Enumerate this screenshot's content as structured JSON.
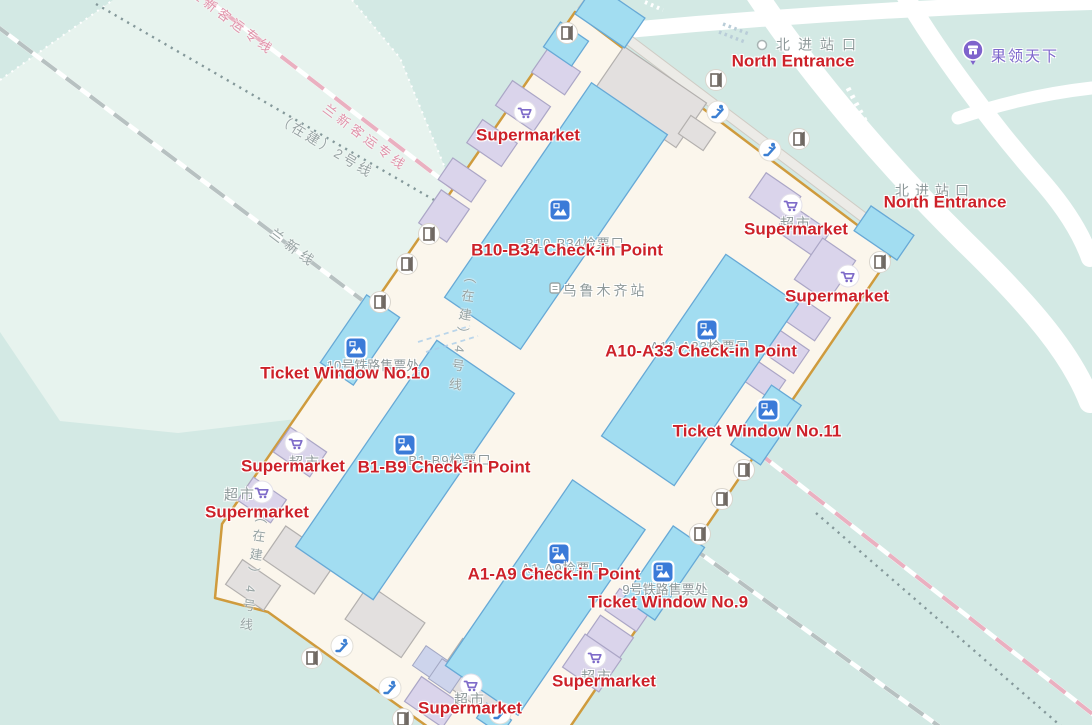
{
  "map": {
    "station": {
      "name_cn": "乌鲁木齐站"
    },
    "colors": {
      "background_teal": "#d3e9e4",
      "light_area": "#e7f3ee",
      "building_fill": "#fbf6ec",
      "building_border": "#cf9b3d",
      "checkin_fill": "#a2ddf1",
      "checkin_stroke": "#67a9d6",
      "shop_fill": "#dad4eb",
      "gray_building": "#e3e0df",
      "poi_red": "#cd2129",
      "map_gray_text": "#8e999a",
      "rail_pink": "#eab0c0",
      "purple_poi": "#7d66cc",
      "road_white": "#ffffff"
    },
    "rail_lines": [
      {
        "name": "兰新客运专线",
        "style": "pink-white-dashed"
      },
      {
        "name": "（在建）2号线",
        "style": "gray-dotted"
      },
      {
        "name": "兰新线",
        "style": "gray-white-dashed"
      },
      {
        "name": "（在建）4号线",
        "style": "under-construction-vertical-label"
      }
    ],
    "labels": [
      {
        "name": "rail-label",
        "kind": "pink",
        "text": "兰新客运专线",
        "x": 232,
        "y": 22,
        "rot": 37,
        "clickable": false
      },
      {
        "name": "rail-label",
        "kind": "pink",
        "text": "兰新客运专线",
        "x": 365,
        "y": 138,
        "rot": 37,
        "clickable": false
      },
      {
        "name": "rail-label",
        "kind": "rail",
        "text": "（在建）2号线",
        "x": 325,
        "y": 147,
        "rot": 31,
        "clickable": false
      },
      {
        "name": "rail-label",
        "kind": "rail",
        "text": "兰新线",
        "x": 293,
        "y": 249,
        "rot": 37,
        "ls": 5,
        "clickable": false
      },
      {
        "name": "rail-label-vertical",
        "kind": "railv",
        "text": "（在建）4号线",
        "x": 461,
        "y": 333,
        "rot": 8,
        "clickable": false
      },
      {
        "name": "rail-label-vertical",
        "kind": "railv",
        "text": "（在建）4号线",
        "x": 252,
        "y": 573,
        "rot": 8,
        "clickable": false
      },
      {
        "name": "north-entrance-cn-label",
        "kind": "cn",
        "text": "北进站口",
        "x": 820,
        "y": 45,
        "ls": 8,
        "clickable": true
      },
      {
        "name": "north-entrance-cn-label",
        "kind": "cn",
        "text": "北进站口",
        "x": 935,
        "y": 191,
        "ls": 6,
        "clickable": true
      },
      {
        "name": "station-name-label",
        "kind": "cn",
        "text": "乌鲁木齐站",
        "x": 605,
        "y": 291,
        "clickable": true
      },
      {
        "name": "checkin-cn-label",
        "kind": "cn",
        "text": "B10-B34检票口",
        "x": 575,
        "y": 244,
        "size": 13,
        "ls": 1,
        "clickable": true
      },
      {
        "name": "checkin-cn-label",
        "kind": "cn",
        "text": "A10-A33检票口",
        "x": 700,
        "y": 347,
        "size": 13,
        "ls": 1,
        "clickable": true
      },
      {
        "name": "checkin-cn-label",
        "kind": "cn",
        "text": "B1-B9检票口",
        "x": 450,
        "y": 461,
        "size": 13,
        "ls": 1,
        "clickable": true
      },
      {
        "name": "checkin-cn-label",
        "kind": "cn",
        "text": "A1-A9检票口",
        "x": 563,
        "y": 569,
        "size": 13,
        "ls": 1,
        "clickable": true
      },
      {
        "name": "ticket-window-cn-label",
        "kind": "cn",
        "text": "10号铁路售票处",
        "x": 373,
        "y": 366,
        "size": 13,
        "ls": 0,
        "clickable": true
      },
      {
        "name": "ticket-window-cn-label",
        "kind": "cn",
        "text": "9号铁路售票处",
        "x": 665,
        "y": 590,
        "size": 13,
        "ls": 0,
        "clickable": true
      },
      {
        "name": "supermarket-cn-label",
        "kind": "cn",
        "text": "超市",
        "x": 305,
        "y": 463,
        "ls": 2,
        "clickable": true
      },
      {
        "name": "supermarket-cn-label",
        "kind": "cn",
        "text": "超市",
        "x": 240,
        "y": 495,
        "ls": 2,
        "clickable": true
      },
      {
        "name": "supermarket-cn-label",
        "kind": "cn",
        "text": "超市",
        "x": 597,
        "y": 677,
        "ls": 2,
        "clickable": true
      },
      {
        "name": "supermarket-cn-label",
        "kind": "cn",
        "text": "超市",
        "x": 470,
        "y": 700,
        "ls": 2,
        "clickable": true
      },
      {
        "name": "supermarket-cn-label",
        "kind": "cn",
        "text": "超市",
        "x": 796,
        "y": 224,
        "ls": 2,
        "clickable": true
      },
      {
        "name": "supermarket-label",
        "kind": "poi",
        "text": "Supermarket",
        "x": 528,
        "y": 136,
        "clickable": true
      },
      {
        "name": "north-entrance-label",
        "kind": "poi",
        "text": "North Entrance",
        "x": 793,
        "y": 62,
        "clickable": true
      },
      {
        "name": "north-entrance-label",
        "kind": "poi",
        "text": "North Entrance",
        "x": 945,
        "y": 203,
        "clickable": true
      },
      {
        "name": "supermarket-label",
        "kind": "poi",
        "text": "Supermarket",
        "x": 796,
        "y": 230,
        "clickable": true
      },
      {
        "name": "supermarket-label",
        "kind": "poi",
        "text": "Supermarket",
        "x": 837,
        "y": 297,
        "clickable": true
      },
      {
        "name": "checkin-label",
        "kind": "poi",
        "text": "B10-B34 Check-in Point",
        "x": 567,
        "y": 251,
        "clickable": true
      },
      {
        "name": "checkin-label",
        "kind": "poi",
        "text": "A10-A33 Check-in Point",
        "x": 701,
        "y": 352,
        "clickable": true
      },
      {
        "name": "ticket-window-label",
        "kind": "poi",
        "text": "Ticket Window No.10",
        "x": 345,
        "y": 374,
        "clickable": true
      },
      {
        "name": "ticket-window-label",
        "kind": "poi",
        "text": "Ticket Window No.11",
        "x": 757,
        "y": 432,
        "clickable": true
      },
      {
        "name": "supermarket-label",
        "kind": "poi",
        "text": "Supermarket",
        "x": 293,
        "y": 467,
        "clickable": true
      },
      {
        "name": "checkin-label",
        "kind": "poi",
        "text": "B1-B9 Check-in Point",
        "x": 444,
        "y": 468,
        "clickable": true
      },
      {
        "name": "supermarket-label",
        "kind": "poi",
        "text": "Supermarket",
        "x": 257,
        "y": 513,
        "clickable": true
      },
      {
        "name": "checkin-label",
        "kind": "poi",
        "text": "A1-A9 Check-in Point",
        "x": 554,
        "y": 575,
        "clickable": true
      },
      {
        "name": "ticket-window-label",
        "kind": "poi",
        "text": "Ticket Window No.9",
        "x": 668,
        "y": 603,
        "clickable": true
      },
      {
        "name": "supermarket-label",
        "kind": "poi",
        "text": "Supermarket",
        "x": 604,
        "y": 682,
        "clickable": true
      },
      {
        "name": "supermarket-label",
        "kind": "poi",
        "text": "Supermarket",
        "x": 470,
        "y": 709,
        "clickable": true
      },
      {
        "name": "shop-poi-label",
        "kind": "shop",
        "text": "果领天下",
        "x": 1025,
        "y": 57,
        "clickable": true
      }
    ],
    "icons": [
      {
        "type": "checkin",
        "x": 560,
        "y": 210
      },
      {
        "type": "checkin",
        "x": 707,
        "y": 330
      },
      {
        "type": "checkin",
        "x": 405,
        "y": 445
      },
      {
        "type": "checkin",
        "x": 559,
        "y": 554
      },
      {
        "type": "checkin",
        "x": 356,
        "y": 348
      },
      {
        "type": "checkin",
        "x": 768,
        "y": 410
      },
      {
        "type": "checkin",
        "x": 663,
        "y": 572
      },
      {
        "type": "cart",
        "x": 525,
        "y": 112
      },
      {
        "type": "cart",
        "x": 791,
        "y": 205
      },
      {
        "type": "cart",
        "x": 848,
        "y": 276
      },
      {
        "type": "cart",
        "x": 296,
        "y": 443
      },
      {
        "type": "cart",
        "x": 262,
        "y": 492
      },
      {
        "type": "cart",
        "x": 595,
        "y": 657
      },
      {
        "type": "cart",
        "x": 471,
        "y": 685
      },
      {
        "type": "escalator",
        "x": 718,
        "y": 112
      },
      {
        "type": "escalator",
        "x": 770,
        "y": 150
      },
      {
        "type": "escalator",
        "x": 342,
        "y": 646
      },
      {
        "type": "escalator",
        "x": 390,
        "y": 688
      },
      {
        "type": "escalator",
        "x": 500,
        "y": 713
      },
      {
        "type": "door",
        "x": 567,
        "y": 33
      },
      {
        "type": "door",
        "x": 716,
        "y": 80
      },
      {
        "type": "door",
        "x": 799,
        "y": 139
      },
      {
        "type": "door",
        "x": 880,
        "y": 262
      },
      {
        "type": "door",
        "x": 429,
        "y": 234
      },
      {
        "type": "door",
        "x": 407,
        "y": 264
      },
      {
        "type": "door",
        "x": 380,
        "y": 302
      },
      {
        "type": "door",
        "x": 744,
        "y": 470
      },
      {
        "type": "door",
        "x": 722,
        "y": 499
      },
      {
        "type": "door",
        "x": 700,
        "y": 534
      },
      {
        "type": "door",
        "x": 312,
        "y": 658
      },
      {
        "type": "door",
        "x": 403,
        "y": 719
      },
      {
        "type": "entrance-marker",
        "x": 762,
        "y": 45
      },
      {
        "type": "station-marker",
        "x": 555,
        "y": 288
      },
      {
        "type": "shop-pin",
        "x": 973,
        "y": 50
      }
    ]
  }
}
